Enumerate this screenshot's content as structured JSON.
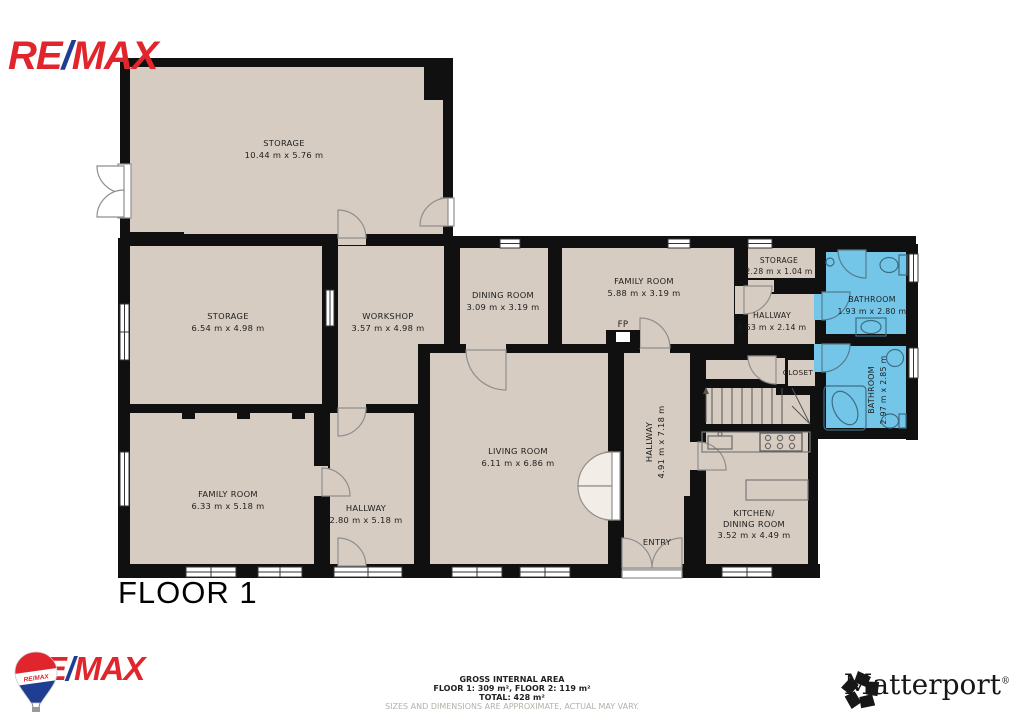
{
  "branding": {
    "remax_top": {
      "re": "RE",
      "slash": "/",
      "max": "MAX"
    },
    "remax_bottom": {
      "re": "RE",
      "slash": "/",
      "max": "MAX"
    },
    "remax_balloon_text": "RE/MAX",
    "matterport_name": "Matterport",
    "matterport_reg": "®"
  },
  "floor_label": "FLOOR 1",
  "rooms": {
    "storage_top": {
      "name": "STORAGE",
      "dims": "10.44 m x 5.76 m"
    },
    "storage_left": {
      "name": "STORAGE",
      "dims": "6.54 m x 4.98 m"
    },
    "workshop": {
      "name": "WORKSHOP",
      "dims": "3.57 m x 4.98 m"
    },
    "dining": {
      "name": "DINING ROOM",
      "dims": "3.09 m x 3.19 m"
    },
    "family_top": {
      "name": "FAMILY ROOM",
      "dims": "5.88 m x 3.19 m"
    },
    "storage_small": {
      "name": "STORAGE",
      "dims": "2.28 m x 1.04 m"
    },
    "hallway_ne": {
      "name": "HALLWAY",
      "dims": "3.63 m x 2.14 m"
    },
    "bathroom_1": {
      "name": "BATHROOM",
      "dims": "1.93 m x 2.80 m"
    },
    "closet": {
      "name": "CLOSET"
    },
    "bathroom_2": {
      "name": "BATHROOM",
      "dims": "2.97 m x 2.85 m"
    },
    "family_bottom": {
      "name": "FAMILY ROOM",
      "dims": "6.33 m x 5.18 m"
    },
    "hallway_sw": {
      "name": "HALLWAY",
      "dims": "2.80 m x 5.18 m"
    },
    "living": {
      "name": "LIVING ROOM",
      "dims": "6.11 m x 6.86 m"
    },
    "hallway_main": {
      "name": "HALLWAY",
      "dims": "4.91 m x 7.18 m"
    },
    "entry": {
      "name": "ENTRY"
    },
    "kitchen": {
      "name_line1": "KITCHEN/",
      "name_line2": "DINING ROOM",
      "dims": "3.52 m x 4.49 m"
    },
    "fireplace": {
      "label": "FP"
    }
  },
  "footer": {
    "line1": "GROSS INTERNAL AREA",
    "line2": "FLOOR 1: 309 m², FLOOR 2: 119 m²",
    "line3": "TOTAL: 428 m²",
    "line4": "SIZES AND DIMENSIONS ARE APPROXIMATE, ACTUAL MAY VARY."
  },
  "colors": {
    "floor": "#D7CCC1",
    "wall": "#101010",
    "bathroom_blue": "#74C6E9",
    "remax_red": "#E0252D",
    "remax_blue": "#1F3E92",
    "disclaimer_gray": "#B5B0AA"
  }
}
